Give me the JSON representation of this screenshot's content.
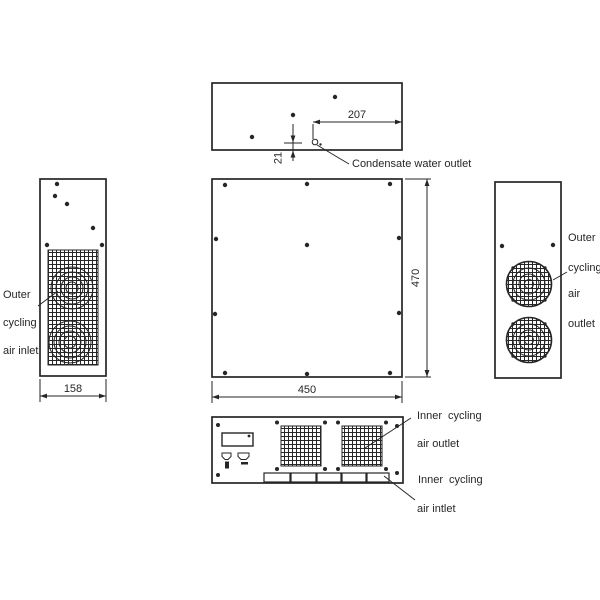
{
  "canvas": {
    "background": "#ffffff",
    "line_color": "#262626"
  },
  "dimensions": {
    "condensate_offset_x": "207",
    "condensate_offset_y": "21",
    "cabinet_width": "450",
    "cabinet_height": "470",
    "cabinet_depth": "158"
  },
  "labels": {
    "condensate_water_outlet": "Condensate water outlet",
    "outer_cycling_air_inlet": {
      "line1": "Outer",
      "line2": "cycling",
      "line3": "air inlet"
    },
    "outer_cycling_air_outlet": {
      "line1": "Outer",
      "line2": "cycling",
      "line3": "air",
      "line4": "outlet"
    },
    "inner_cycling_air_outlet": {
      "word1": "Inner",
      "word2": "cycling",
      "line2": "air outlet"
    },
    "inner_cycling_air_inlet": {
      "word1": "Inner",
      "word2": "cycling",
      "line2": "air intlet"
    }
  }
}
